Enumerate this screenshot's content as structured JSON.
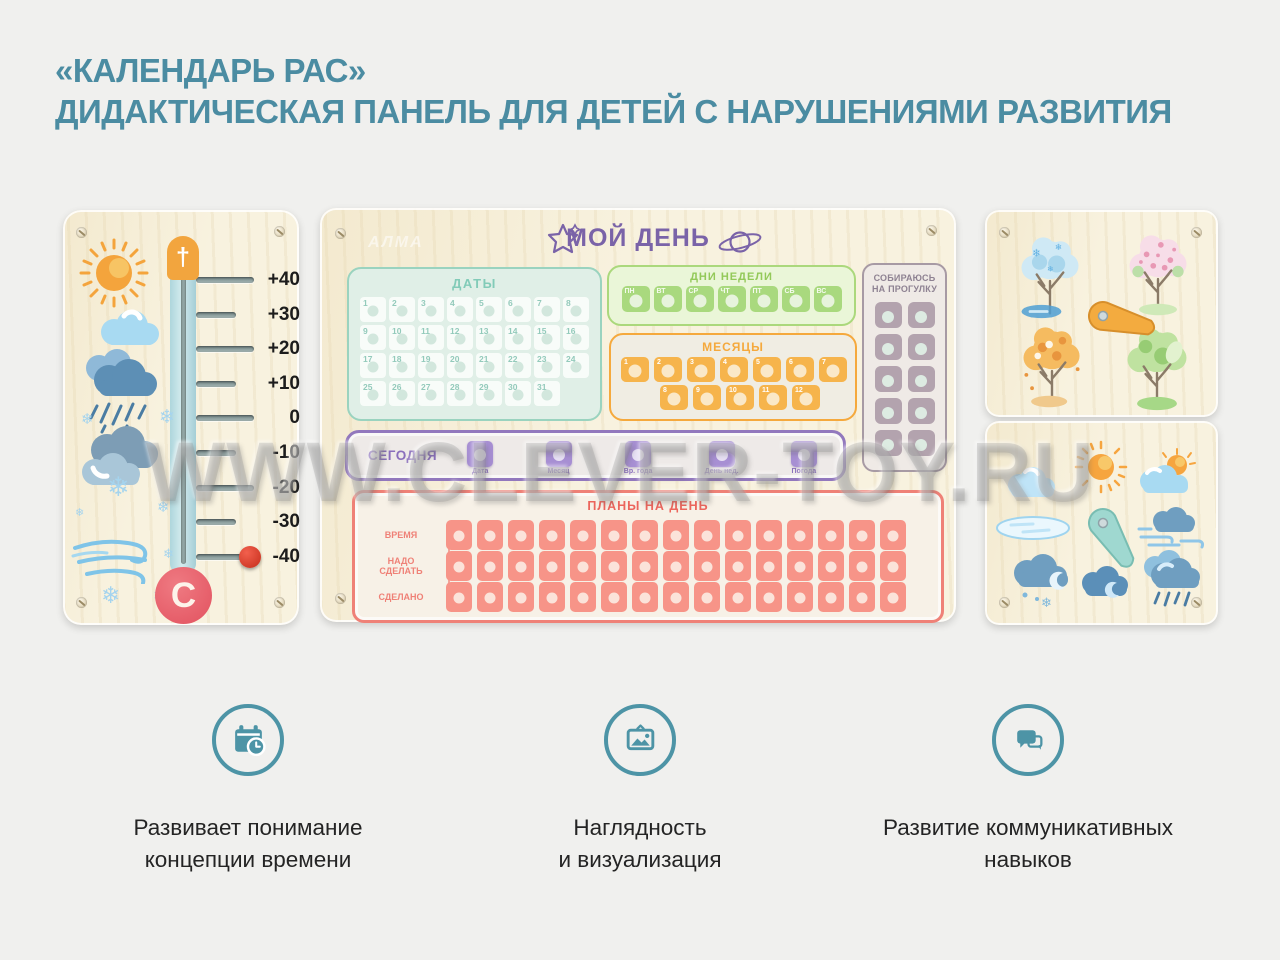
{
  "title": {
    "line1": "«КАЛЕНДАРЬ РАС»",
    "line2": "ДИДАКТИЧЕСКАЯ ПАНЕЛЬ ДЛЯ ДЕТЕЙ С НАРУШЕНИЯМИ РАЗВИТИЯ"
  },
  "watermark": "WWW.CLEVER-TOY.RU",
  "colors": {
    "title_teal": "#4b8ca2",
    "feature_teal": "#4d94a6",
    "purple": "#7a63a8",
    "green": "#a9d97e",
    "orange": "#f6b44c",
    "mint": "#9ad3bf",
    "salmon": "#f79488",
    "mauve": "#b3a3ae",
    "wood": "#f8f2df",
    "thermo_red": "#e2525f",
    "knob_red": "#c52d1b"
  },
  "thermometer": {
    "top_symbol": "†",
    "unit_symbol": "C",
    "scale_labels": [
      "+40",
      "+30",
      "+20",
      "+10",
      "0",
      "-10",
      "-20",
      "-30",
      "-40"
    ],
    "knob_at": "-40",
    "side_icons": [
      "sun-icon",
      "cloud-icon",
      "rain-cloud-icon",
      "snow-clouds-icon",
      "snowflakes-icon",
      "wind-icon"
    ]
  },
  "main_panel": {
    "logo": "АЛМА",
    "title": "МОЙ ДЕНЬ",
    "decor_icons": [
      "star-doodle-icon",
      "saturn-doodle-icon"
    ],
    "dates": {
      "title": "ДАТЫ",
      "cells": [
        "1",
        "2",
        "3",
        "4",
        "5",
        "6",
        "7",
        "8",
        "9",
        "10",
        "11",
        "12",
        "13",
        "14",
        "15",
        "16",
        "17",
        "18",
        "19",
        "20",
        "21",
        "22",
        "23",
        "24",
        "25",
        "26",
        "27",
        "28",
        "29",
        "30",
        "31"
      ]
    },
    "weekdays": {
      "title": "ДНИ НЕДЕЛИ",
      "cells": [
        "ПН",
        "ВТ",
        "СР",
        "ЧТ",
        "ПТ",
        "СБ",
        "ВС"
      ]
    },
    "months": {
      "title": "МЕСЯЦЫ",
      "row1": [
        "1",
        "2",
        "3",
        "4",
        "5",
        "6",
        "7"
      ],
      "row2": [
        "8",
        "9",
        "10",
        "11",
        "12"
      ]
    },
    "walk": {
      "title_line1": "СОБИРАЮСЬ",
      "title_line2": "НА ПРОГУЛКУ",
      "cell_count": 10
    },
    "today": {
      "title": "СЕГОДНЯ",
      "slots": [
        "Дата",
        "Месяц",
        "Вр. года",
        "День нед.",
        "Погода"
      ]
    },
    "plans": {
      "title": "ПЛАНЫ НА ДЕНЬ",
      "row_labels": [
        "ВРЕМЯ",
        "НАДО СДЕЛАТЬ",
        "СДЕЛАНО"
      ],
      "cells_per_row": 15
    }
  },
  "seasons_panel": {
    "items": [
      "winter-tree-icon",
      "spring-tree-icon",
      "autumn-tree-icon",
      "summer-tree-icon"
    ],
    "pointer": "orange-arrow-spinner"
  },
  "weather_panel": {
    "items": [
      "cloud-icon",
      "sun-icon",
      "sun-behind-cloud-icon",
      "ice-puddle-icon",
      "windy-cloud-icon",
      "snow-cloud-moon-icon",
      "cloud-moon-icon",
      "rain-cloud-icon"
    ],
    "pointer": "teal-arrow-spinner"
  },
  "features": [
    {
      "icon": "calendar-clock-icon",
      "line1": "Развивает понимание",
      "line2": "концепции времени"
    },
    {
      "icon": "picture-icon",
      "line1": "Наглядность",
      "line2": "и визуализация"
    },
    {
      "icon": "chat-icon",
      "line1": "Развитие коммуникативных",
      "line2": "навыков"
    }
  ]
}
